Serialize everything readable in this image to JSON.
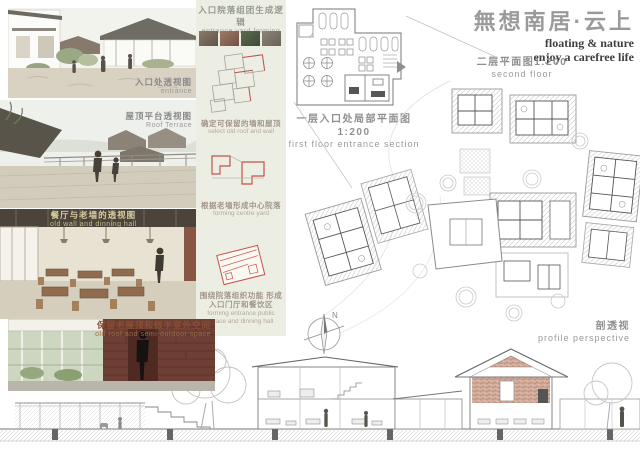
{
  "poster": {
    "title_cn": "無想南居·云上",
    "subtitle_line1": "floating & nature",
    "subtitle_line2": "enjoy a carefree life"
  },
  "left_column": {
    "images": [
      {
        "caption_cn": "入口处透视图",
        "caption_en": "entrance"
      },
      {
        "caption_cn": "屋顶平台透视图",
        "caption_en": "Roof Terrace"
      },
      {
        "caption_cn": "餐厅与老墙的透视图",
        "caption_en": "old wall and dinning hall"
      },
      {
        "caption_cn": "保留老屋顶和做半室外空间",
        "caption_en": "old roof and semi-outdoor space"
      }
    ]
  },
  "process_column": {
    "title_cn": "入口院落组团生成逻辑",
    "title_en": "entrance yard forming",
    "steps": [
      {
        "caption_cn": "确定可保留的墙和屋顶",
        "caption_en": "select old roof and wall"
      },
      {
        "caption_cn": "根据老墙形成中心院落",
        "caption_en": "forming centre yard"
      },
      {
        "caption_cn": "围绕院落组织功能 形成入口门厅和餐饮区",
        "caption_en": "forming entrance public space and dinning hall"
      }
    ]
  },
  "plans": {
    "first_floor": {
      "label_cn": "一层入口处局部平面图1:200",
      "label_en": "first floor entrance section"
    },
    "second_floor": {
      "label_cn": "二层平面图1:200",
      "label_en": "second floor"
    },
    "section": {
      "label_cn": "剖透视",
      "label_en": "profile perspective"
    },
    "compass_n": "N",
    "scale": "1:200"
  },
  "colors": {
    "strip_bg": "#edeee3",
    "title_gray": "#9a9a9a",
    "label_gray": "#8f8f8f",
    "accent_red": "#c0544a",
    "brick": "#6e3f35",
    "caption_brown": "#8a4f33"
  }
}
